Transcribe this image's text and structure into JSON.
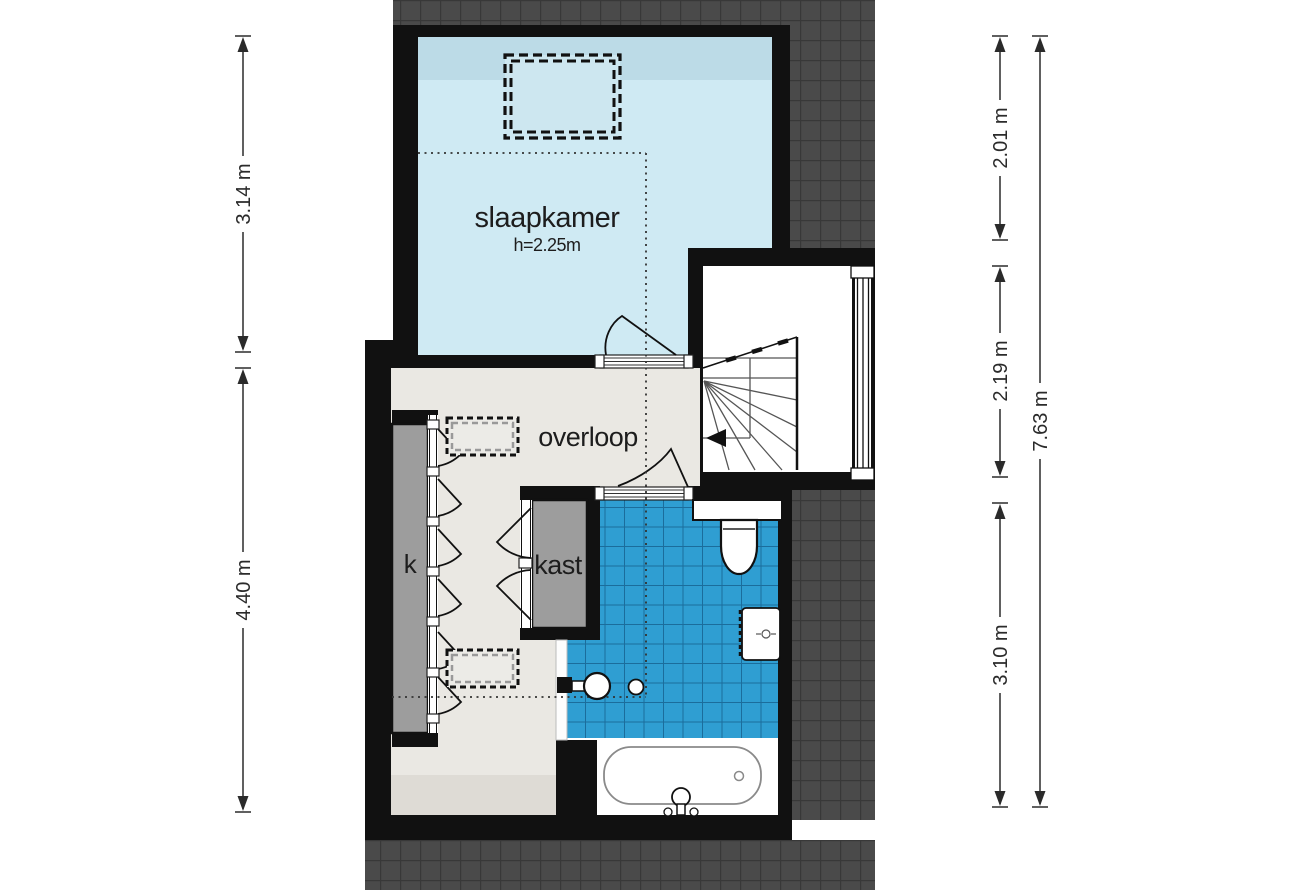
{
  "rooms": {
    "slaapkamer": {
      "label": "slaapkamer",
      "height_note": "h=2.25m"
    },
    "overloop": {
      "label": "overloop"
    },
    "closet_k": {
      "label": "k"
    },
    "kast": {
      "label": "kast"
    }
  },
  "dimensions": {
    "left": [
      {
        "value": "3.14 m"
      },
      {
        "value": "4.40 m"
      }
    ],
    "right_inner": [
      {
        "value": "2.01 m"
      },
      {
        "value": "2.19 m"
      },
      {
        "value": "3.10 m"
      }
    ],
    "right_outer": [
      {
        "value": "7.63 m"
      }
    ]
  },
  "fixtures": {
    "staircase": "winder stairs with down-direction arrow",
    "toilet": "toilet with cistern",
    "radiator": "radiator",
    "washbasin": "round washbasin with tap",
    "bathtub": "bathtub with faucet and drain",
    "window": "window in stairwell wall",
    "roof_windows": "dashed roof-window outlines"
  },
  "colors": {
    "wall": "#111111",
    "bedroom_floor": "#cfeaf3",
    "bedroom_band": "#bcdbe7",
    "hall_floor": "#eae8e3",
    "hall_floor_dark": "#dedbd5",
    "closet_gray": "#9d9d9d",
    "tile": "#2f9ed2",
    "tile_line": "#1b6d9c",
    "hatch": "#4a4a4a",
    "hatch_line": "#383838",
    "room_white": "#ffffff",
    "text": "#1d1d1d",
    "dim": "#2b2b2b",
    "fixture_stroke": "#111111"
  }
}
